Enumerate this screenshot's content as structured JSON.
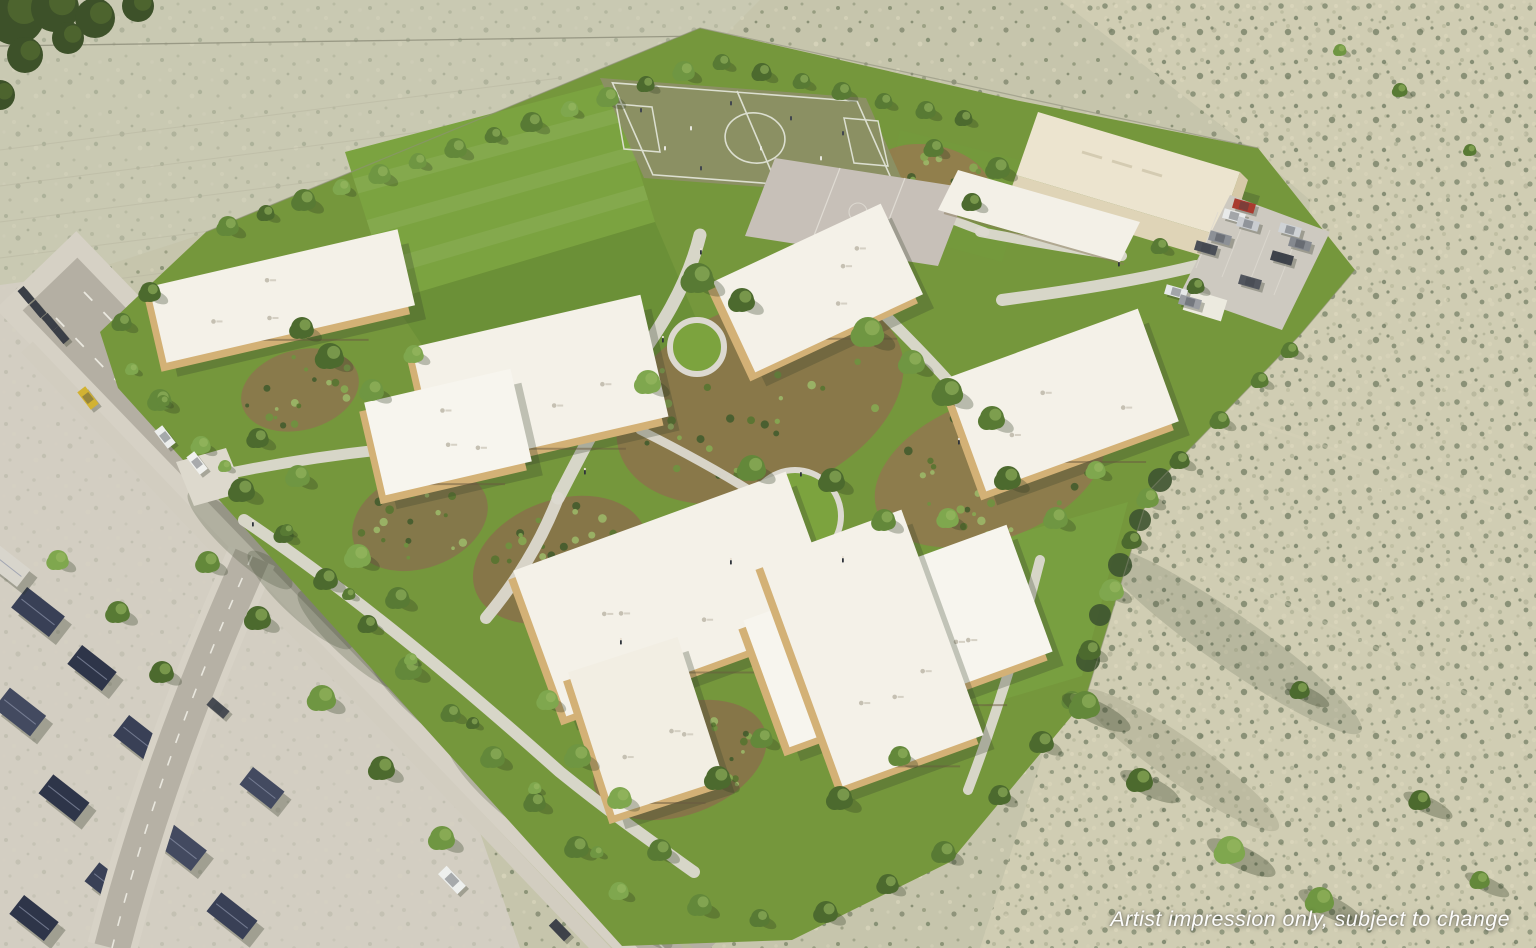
{
  "image": {
    "kind": "aerial artist impression render",
    "subject": "new school campus masterplan surrounded by scrubland and a suburban street network",
    "caption": "Artist impression only, subject to change"
  },
  "palette": {
    "scrub_base": "#c6c5ac",
    "scrub_sand": "#d7d2b8",
    "campus_grass": "#75973c",
    "lawn_light": "#7ba340",
    "turf_field": "#8b9063",
    "court_paving": "#c7c0b8",
    "roof_white": "#f4f1e8",
    "gym_cream": "#ece4cf",
    "facade_tan": "#d3b176",
    "mulch_garden": "#8e724c",
    "path_concrete": "#dcd9d0",
    "road_asphalt": "#b4afa3",
    "house_roof_slate": "#394056",
    "tree_dark": "#3f5a2b",
    "tree_light": "#86ab52",
    "car_red": "#a93b2f",
    "car_yellow": "#d2b232",
    "caption_color": "#ffffff"
  },
  "features": [
    {
      "id": "scrubland",
      "label": "Surrounding scrubland paddocks"
    },
    {
      "id": "sports-field",
      "label": "Grass sports field with white line markings"
    },
    {
      "id": "games-courts",
      "label": "Paved games courts"
    },
    {
      "id": "gym-building",
      "label": "Gymnasium / hall building"
    },
    {
      "id": "parking-lot",
      "label": "Car park with parked cars"
    },
    {
      "id": "school-buildings",
      "label": "White flat-roofed school buildings"
    },
    {
      "id": "campus-grounds",
      "label": "Landscaped courtyards, lawns and paths"
    },
    {
      "id": "trees",
      "label": "Perimeter and courtyard tree planting"
    },
    {
      "id": "roads",
      "label": "Suburban roads with median and lane markings"
    },
    {
      "id": "suburb",
      "label": "Existing suburban houses"
    }
  ]
}
